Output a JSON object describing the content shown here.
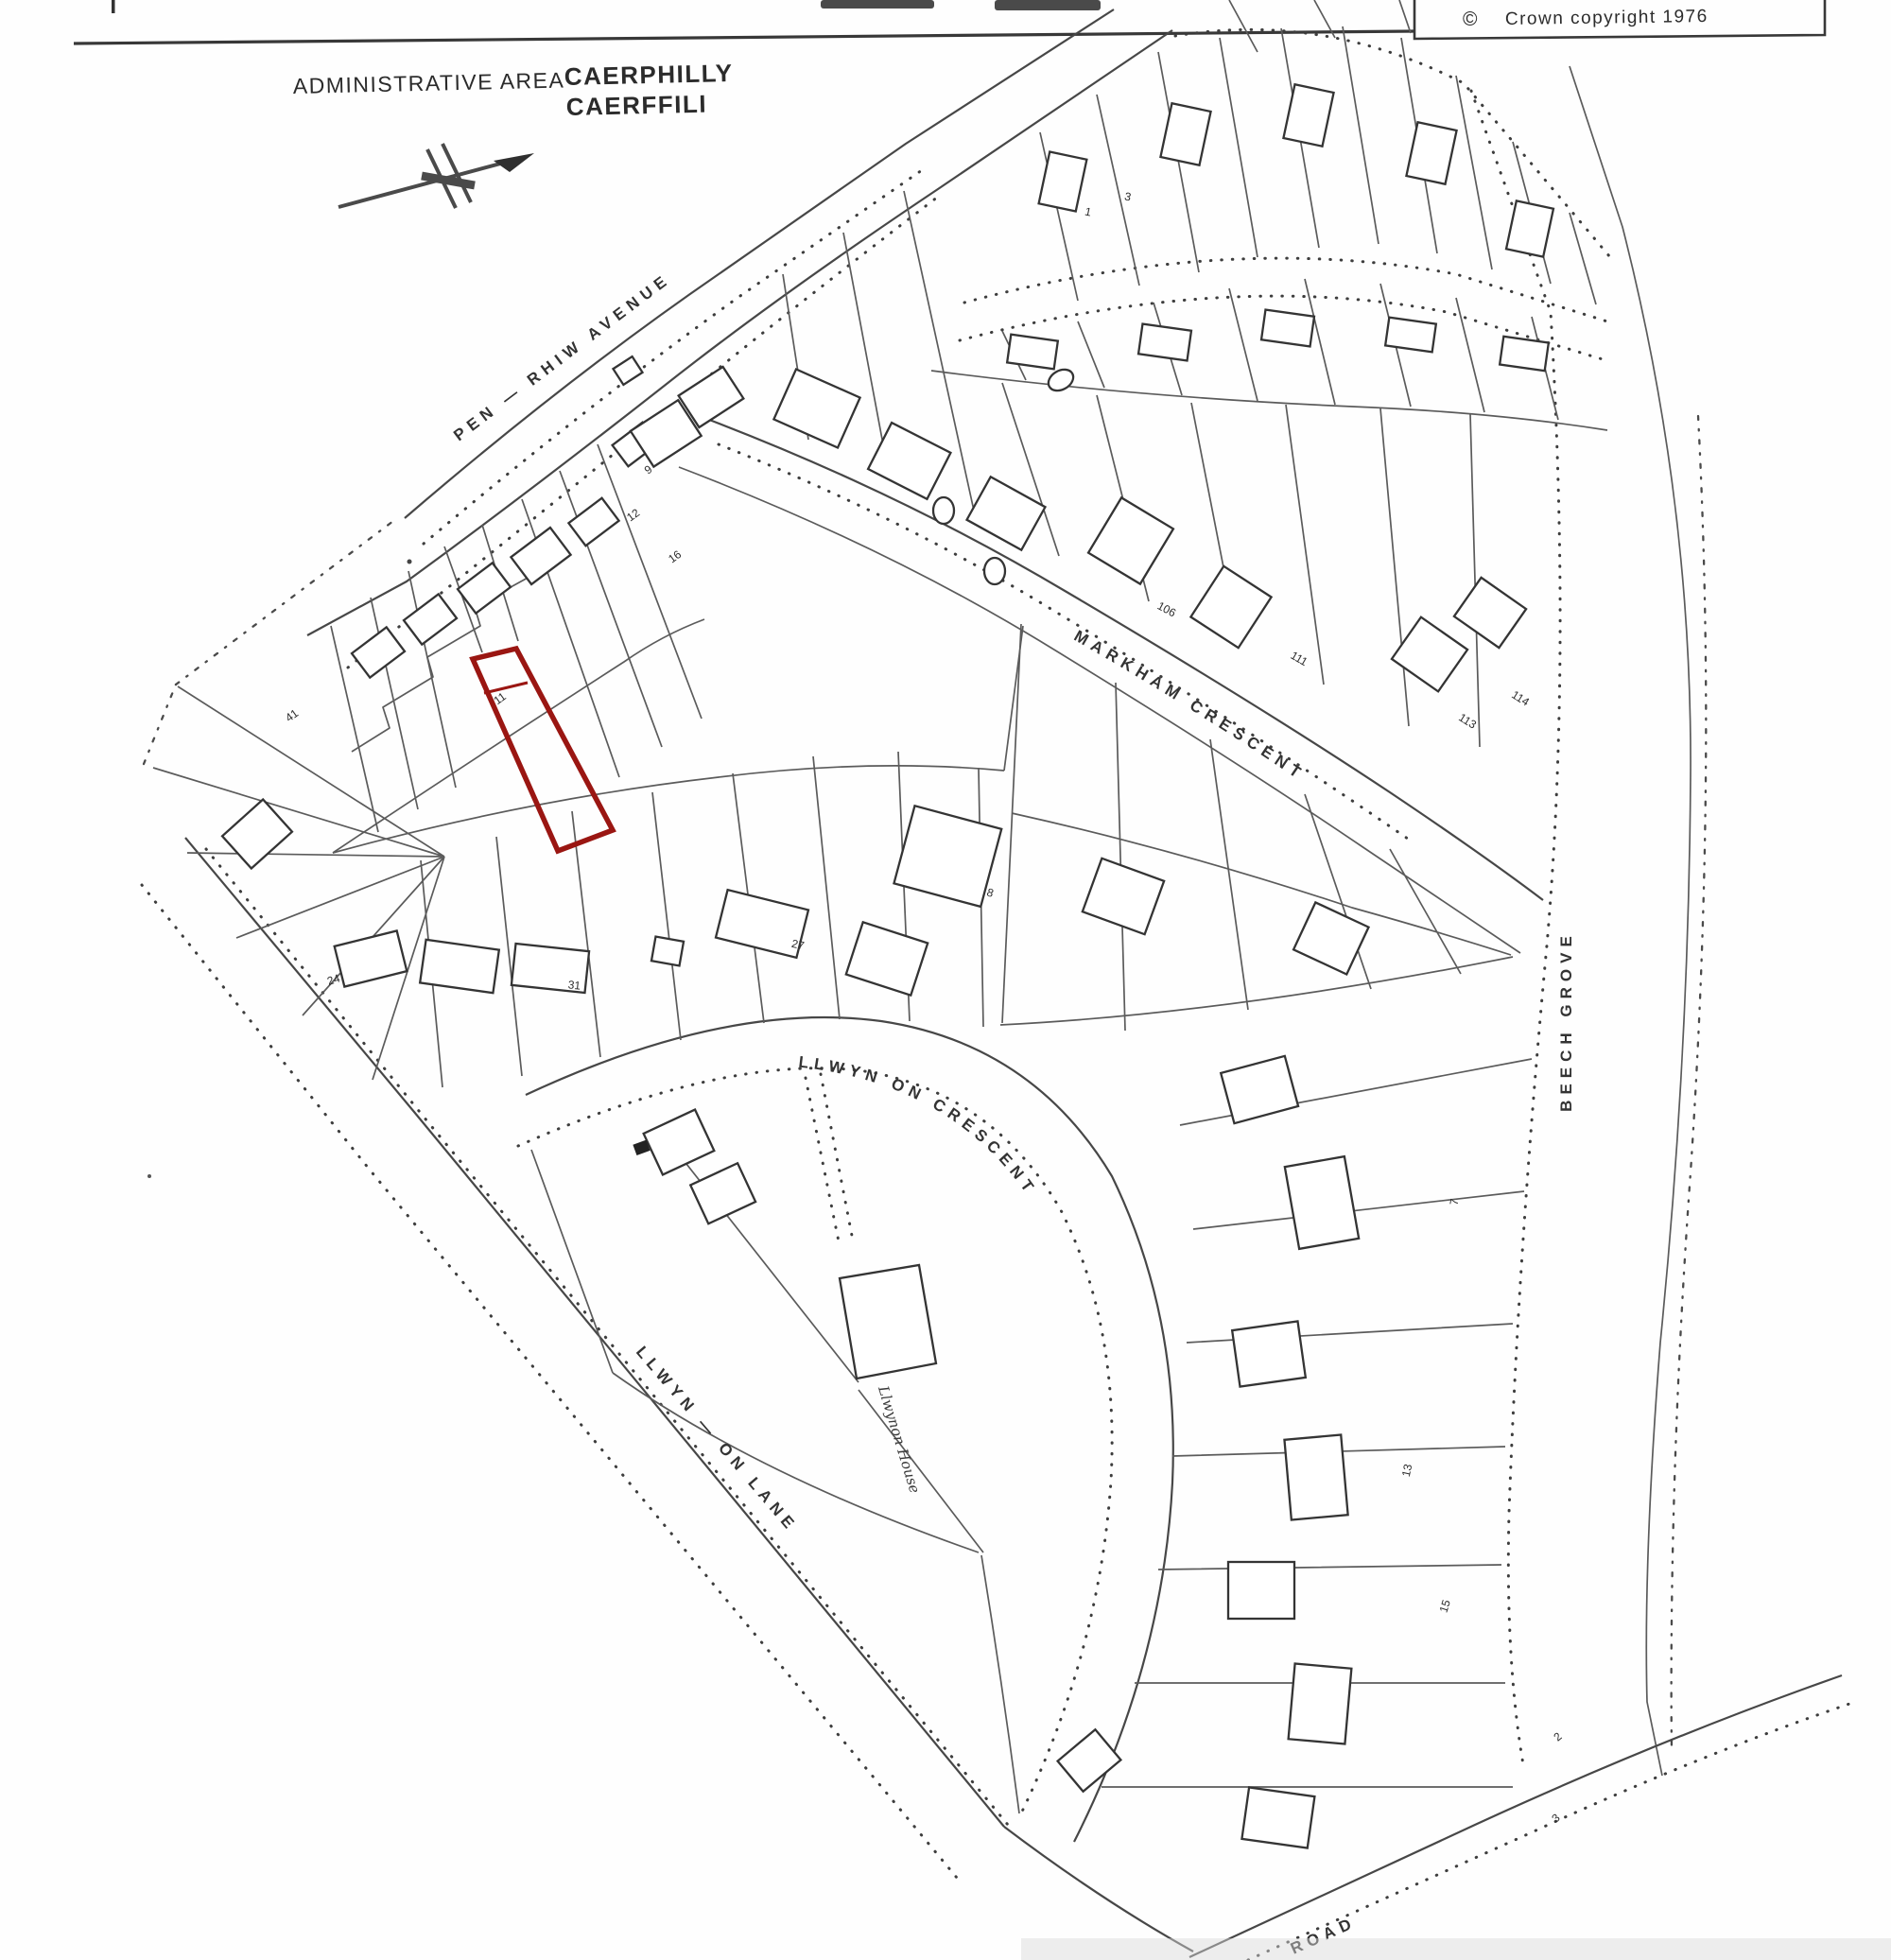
{
  "header": {
    "admin_area_label": "ADMINISTRATIVE AREA",
    "admin_area_value_line1": "CAERPHILLY",
    "admin_area_value_line2": "CAERFFILI",
    "copyright_symbol": "©",
    "copyright_text": "Crown copyright 1976"
  },
  "map": {
    "highlight_color": "#9a1612",
    "streets": [
      {
        "name": "PEN — RHIW AVENUE"
      },
      {
        "name": "MARKHAM CRESCENT"
      },
      {
        "name": "BEECH GROVE"
      },
      {
        "name": "LLWYN ON CRESCENT"
      },
      {
        "name": "LLWYN — ON LANE"
      },
      {
        "name": "ROAD"
      }
    ],
    "places": [
      {
        "name": "Llwynon House"
      }
    ],
    "plot_numbers": [
      "11",
      "41",
      "9",
      "12",
      "16",
      "8",
      "106",
      "111",
      "113",
      "114",
      "31",
      "27",
      "24",
      "1",
      "3",
      "7",
      "13",
      "15",
      "2",
      "3"
    ]
  }
}
